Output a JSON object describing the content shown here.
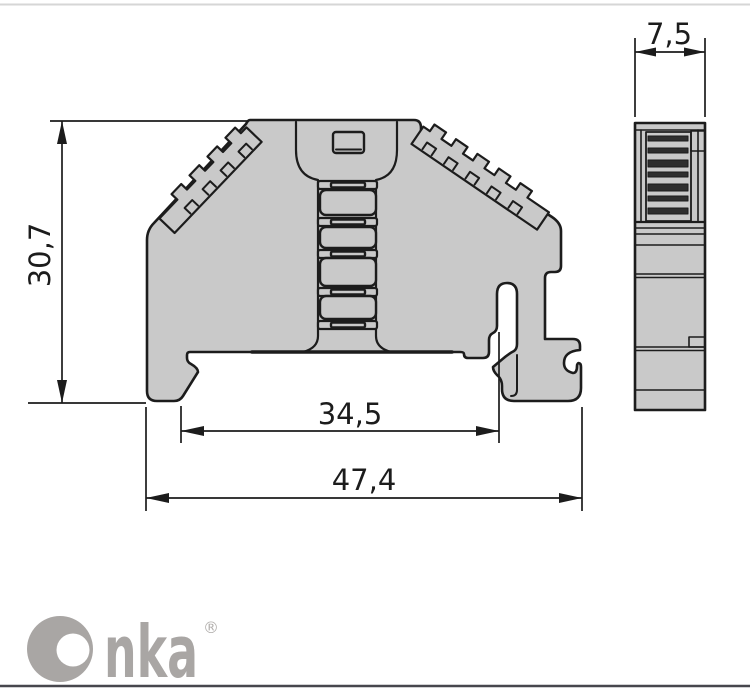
{
  "page": {
    "background": "#ffffff",
    "top_border_color": "#d6d6d6",
    "bottom_border_color": "#47474d"
  },
  "drawing": {
    "type": "technical-drawing",
    "subject": "DIN rail end clamp / terminal block, front and side orthographic views",
    "colors": {
      "body_fill": "#c9c9c9",
      "line": "#1c1c1c",
      "hatch_fill": "#2e2e2e"
    },
    "dimensions": [
      {
        "id": "height",
        "value": "30,7",
        "orientation": "vertical",
        "view": "front"
      },
      {
        "id": "inner-width",
        "value": "34,5",
        "orientation": "horizontal",
        "view": "front"
      },
      {
        "id": "overall-width",
        "value": "47,4",
        "orientation": "horizontal",
        "view": "front"
      },
      {
        "id": "depth",
        "value": "7,5",
        "orientation": "horizontal",
        "view": "side"
      }
    ]
  },
  "logo": {
    "brand": "Onka",
    "brand_tail": "nka",
    "registered": "®",
    "color": "#a9a6a4",
    "registered_color": "#b3b0ae"
  }
}
